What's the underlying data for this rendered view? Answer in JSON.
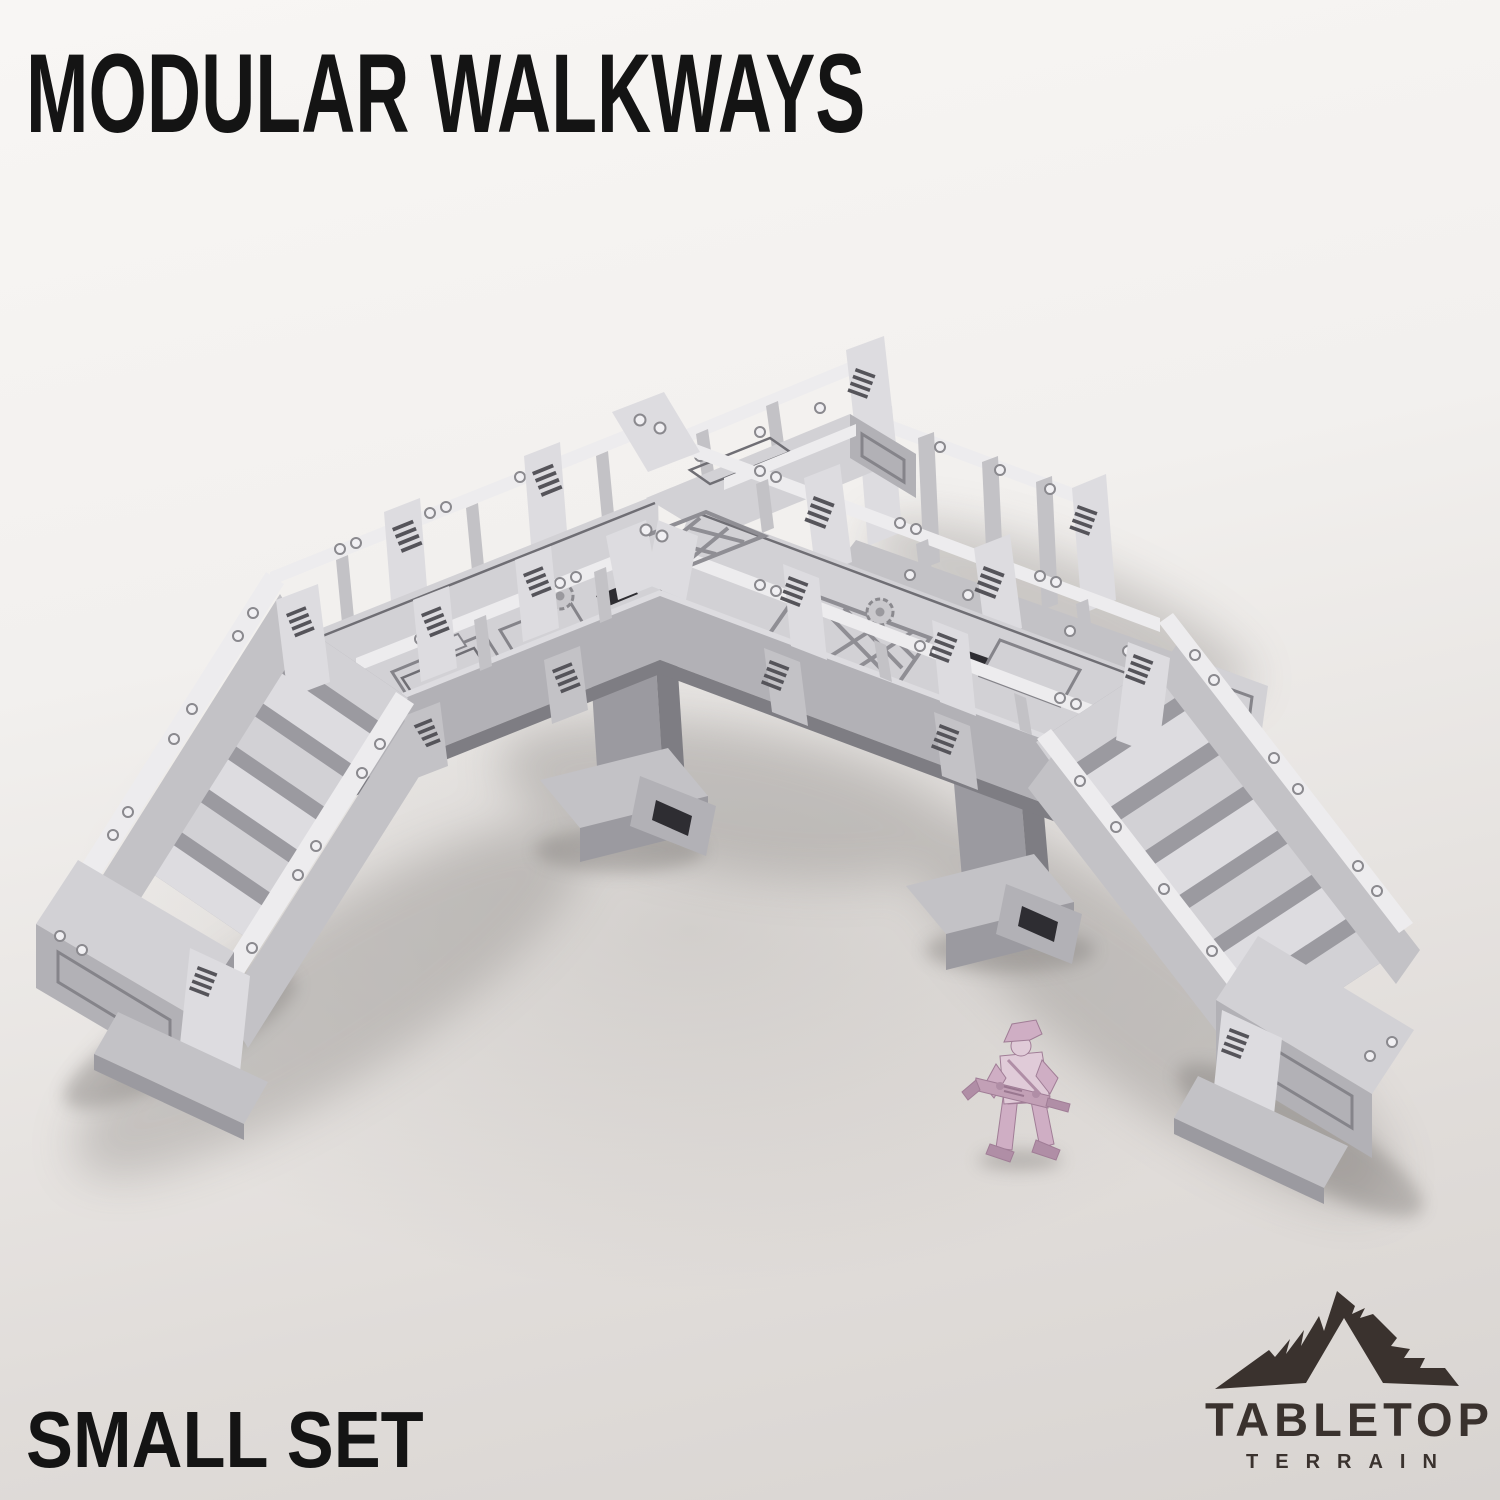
{
  "header": {
    "title": "MODULAR WALKWAYS"
  },
  "footer": {
    "set_label": "SMALL SET"
  },
  "brand": {
    "name": "TABLETOP",
    "tagline": "TERRAIN",
    "icon": "mountain-icon",
    "logo_color": "#3a322e"
  },
  "scene": {
    "subject": "grey 3D-printed modular walkway terrain set",
    "elements": [
      "left-staircase",
      "right-staircase",
      "left-walkway-span",
      "right-walkway-span",
      "rear-branch-walkway",
      "spare-railing-module",
      "support-pillar-left",
      "support-pillar-right",
      "corner-junction",
      "scale-miniature-soldier"
    ]
  },
  "colors": {
    "text_color": "#141414",
    "logo_color": "#3a322e",
    "background_light": "#f8f6f4",
    "background_shadow": "#c9c5c2",
    "model_light": "#edecee",
    "model_mid": "#c3c2c6",
    "model_dark": "#9b9aa0",
    "model_recess": "#2e2d32",
    "miniature_pink_light": "#e0cbd8",
    "miniature_pink_mid": "#cfaec4",
    "miniature_pink_dark": "#b08ea6"
  }
}
